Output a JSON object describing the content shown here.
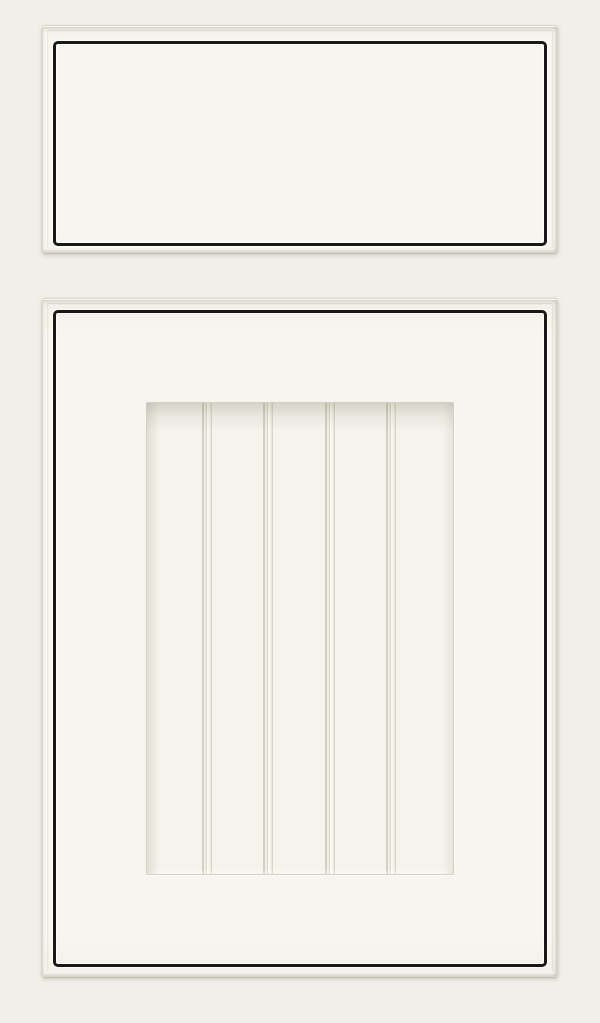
{
  "meta": {
    "description": "Product photo of a white painted inset cabinet drawer front above a matching beadboard cabinet door, each outlined with a thin black bead accent",
    "alt": "White cabinet drawer front and beadboard door sample with black bead accent outline"
  },
  "colors": {
    "background": "#f0efe8",
    "slab_face": "#f6f5ef",
    "panel_face": "#f4f3ec",
    "edge_line": "#d9d6c8",
    "bead_black": "#191816",
    "groove_shadow": "#d2cfc0",
    "groove_line": "#d9d6c8",
    "highlight": "#fcfbf5"
  },
  "components": {
    "drawer_front": {
      "name": "drawer-front"
    },
    "door": {
      "name": "cabinet-door"
    },
    "beadboard_panel": {
      "name": "beadboard-panel",
      "plank_count": 5,
      "groove_count": 4
    }
  }
}
